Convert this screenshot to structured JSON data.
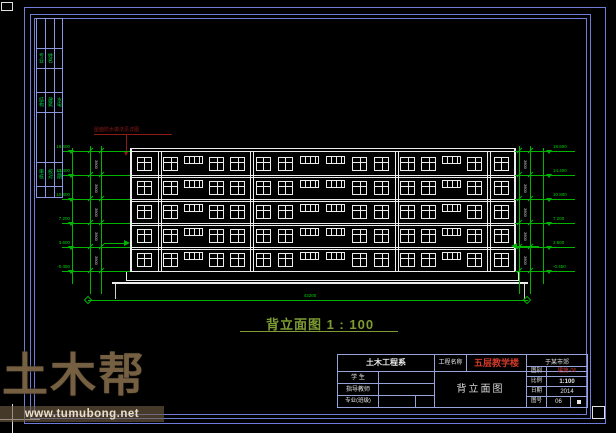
{
  "colors": {
    "frame_blue": "#6e7cd8",
    "titleblock_blue": "#96a2da",
    "line_white": "#ededed",
    "dim_green": "#00b400",
    "text_green": "#00d000",
    "title_green": "#7e9c33",
    "annotation_red": "#8c1a17",
    "project_red": "#d03a2a",
    "watermark_brown": "#7a644a"
  },
  "watermark": {
    "brand": "土木帮",
    "url": "www.tumubong.net"
  },
  "drawing_title": {
    "name": "背立面图",
    "scale": "1 : 100"
  },
  "roof_note": "屋面防水做法见详图",
  "building": {
    "floors": 5,
    "bays": [
      {
        "windows": [
          "w4"
        ]
      },
      {
        "windows": [
          "w4",
          "w3",
          "w4",
          "w4"
        ]
      },
      {
        "windows": [
          "w4",
          "w4",
          "w3",
          "w3",
          "w4",
          "w4"
        ]
      },
      {
        "windows": [
          "w4",
          "w4",
          "w3",
          "w4"
        ]
      },
      {
        "windows": [
          "w4"
        ]
      }
    ]
  },
  "dimensions": {
    "elevations": [
      "18.600",
      "14.400",
      "10.800",
      "7.200",
      "3.600",
      "-0.450"
    ],
    "story_height": "3600",
    "overall_width": "43200"
  },
  "signature_strip": {
    "groups": [
      [
        "专业",
        "姓名"
      ],
      [
        "结构",
        "建筑",
        "水电"
      ],
      [
        "审核",
        "校对",
        "日期"
      ]
    ]
  },
  "title_block": {
    "department": "土木工程系",
    "project_label": "工程名称",
    "project_name": "五层教学楼",
    "location": "于某市郊",
    "rows": [
      {
        "label": "学 生",
        "value": ""
      },
      {
        "label": "指导教师",
        "value": ""
      },
      {
        "label": "专业(班级)",
        "value": ""
      }
    ],
    "drawing_name": "背立面图",
    "right_rows": [
      {
        "label": "图别",
        "value": "建施-06"
      },
      {
        "label": "比例",
        "value": "1:100"
      },
      {
        "label": "日期",
        "value": "2014"
      },
      {
        "label": "图号",
        "value": "06"
      }
    ]
  }
}
